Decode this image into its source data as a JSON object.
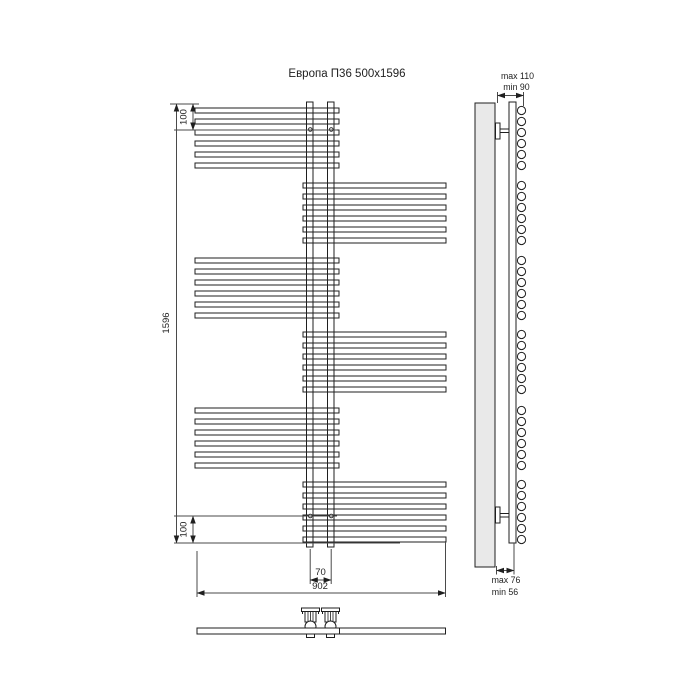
{
  "title": "Европа П36 500x1596",
  "dimensions": {
    "top_offset": "100",
    "overall_height": "1596",
    "bottom_offset": "100",
    "pipe_spacing": "70",
    "overall_width": "902",
    "wall_top_max": "max 110",
    "wall_top_min": "min 90",
    "wall_bottom_max": "max 76",
    "wall_bottom_min": "min 56"
  },
  "colors": {
    "line": "#1f1f1f",
    "dim_line": "#4a4a4a",
    "panel_fill": "#e9e9e9",
    "background": "#ffffff"
  },
  "drawing": {
    "front": {
      "left_bar_x": 195,
      "left_bar_w": 144,
      "right_bar_x": 303,
      "right_bar_w": 143,
      "bar_height": 5,
      "bar_pitch": 11,
      "bars_per_group": 6,
      "bar_groups": [
        {
          "side": "left",
          "y_top": 108
        },
        {
          "side": "right",
          "y_top": 183
        },
        {
          "side": "left",
          "y_top": 258
        },
        {
          "side": "right",
          "y_top": 332
        },
        {
          "side": "left",
          "y_top": 408
        },
        {
          "side": "right",
          "y_top": 482
        }
      ],
      "risers": [
        306.5,
        327.5
      ],
      "riser_w": 6.5,
      "riser_top": 102,
      "riser_bottom": 547,
      "vent_axis_top_y": 129.5,
      "vent_axis_bottom_y": 516
    },
    "side": {
      "circle_cx": 521.5,
      "circle_r": 4.1
    },
    "bottom_view": {
      "valve_centers": [
        310.5,
        330.5
      ]
    }
  }
}
